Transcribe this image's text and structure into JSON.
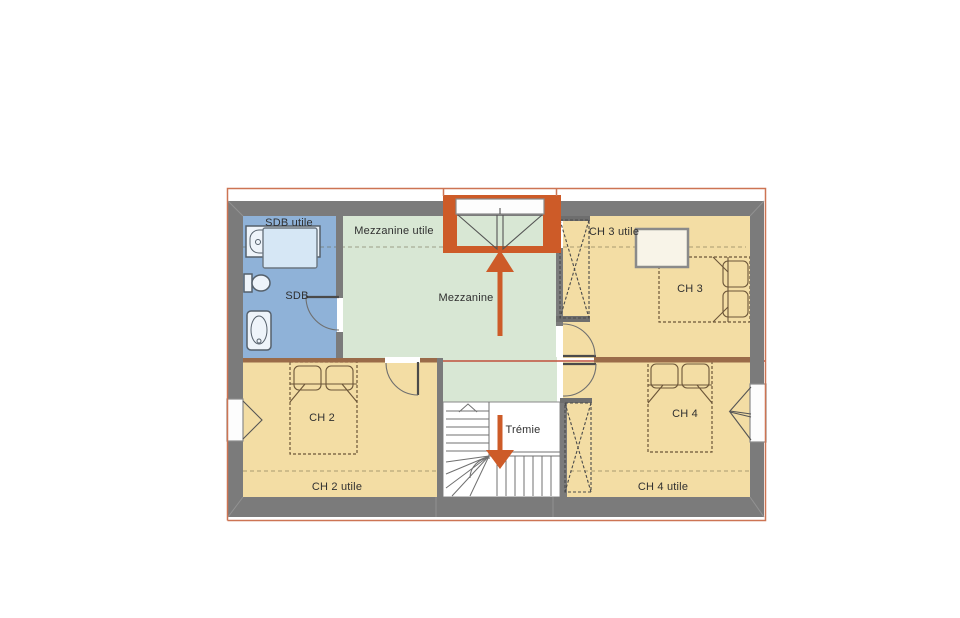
{
  "plan": {
    "labels": {
      "sdb_utile": "SDB utile",
      "mezzanine_utile": "Mezzanine utile",
      "ch3_utile": "CH 3 utile",
      "sdb": "SDB",
      "mezzanine": "Mezzanine",
      "ch3": "CH 3",
      "ch2": "CH 2",
      "ch4": "CH 4",
      "tremie": "Trémie",
      "ch2_utile": "CH 2 utile",
      "ch4_utile": "CH 4 utile"
    },
    "colors": {
      "wall": "#7b7b7b",
      "partition": "#9a6b49",
      "room_beige": "#f3dda4",
      "room_green": "#d8e7d4",
      "room_blue": "#8fb2d8",
      "accent_orange": "#cd5b28",
      "outline": "#cd7453",
      "ridge_line": "#c0503c"
    }
  }
}
